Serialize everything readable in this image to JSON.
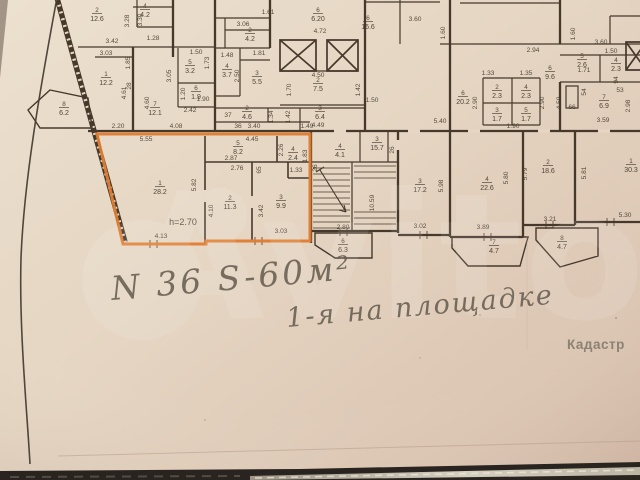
{
  "photo": {
    "watermark_text": "Avito",
    "kadastr_text": "Кадастр",
    "paper_light": "#ece0cf",
    "paper_mid": "#e5d5c2",
    "paper_dark": "#d5bcaa",
    "ink_color": "#46392c",
    "highlight_color": "#e07c30",
    "pencil_color": "#675e51",
    "table_color": "#29241f"
  },
  "annotations": {
    "apartment_note": "N 36  S-60м²",
    "floor_note": "1-я на площадке",
    "height_note": "h=2.70"
  },
  "plan": {
    "rooms": [
      {
        "n": "2",
        "a": "12.6",
        "x": 97,
        "y": 12
      },
      {
        "n": "4",
        "a": "4.2",
        "x": 145,
        "y": 8
      },
      {
        "n": "1",
        "a": "12.2",
        "x": 106,
        "y": 76
      },
      {
        "n": "8",
        "a": "6.2",
        "x": 64,
        "y": 106
      },
      {
        "n": "7",
        "a": "12.1",
        "x": 155,
        "y": 106
      },
      {
        "n": "5",
        "a": "3.2",
        "x": 190,
        "y": 64
      },
      {
        "n": "6",
        "a": "1.9",
        "x": 196,
        "y": 90
      },
      {
        "n": "4",
        "a": "3.7",
        "x": 227,
        "y": 68
      },
      {
        "n": "3",
        "a": "5.5",
        "x": 257,
        "y": 75
      },
      {
        "n": "2",
        "a": "4.2",
        "x": 250,
        "y": 32
      },
      {
        "n": "2",
        "a": "4.6",
        "x": 247,
        "y": 110
      },
      {
        "n": "3",
        "a": "6.4",
        "x": 320,
        "y": 110
      },
      {
        "n": "2",
        "a": "7.5",
        "x": 318,
        "y": 82
      },
      {
        "n": "6",
        "a": "6.20",
        "x": 318,
        "y": 12
      },
      {
        "n": "6",
        "a": "16.6",
        "x": 368,
        "y": 20
      },
      {
        "n": "6",
        "a": "20.2",
        "x": 463,
        "y": 95
      },
      {
        "n": "2",
        "a": "2.3",
        "x": 497,
        "y": 89
      },
      {
        "n": "4",
        "a": "2.3",
        "x": 526,
        "y": 89
      },
      {
        "n": "3",
        "a": "1.7",
        "x": 497,
        "y": 112
      },
      {
        "n": "5",
        "a": "1.7",
        "x": 526,
        "y": 112
      },
      {
        "n": "6",
        "a": "9.6",
        "x": 550,
        "y": 70
      },
      {
        "n": "5",
        "a": "2.6",
        "x": 582,
        "y": 58
      },
      {
        "n": "4",
        "a": "2.3",
        "x": 616,
        "y": 62
      },
      {
        "n": "7",
        "a": "6.9",
        "x": 604,
        "y": 99
      },
      {
        "n": "3",
        "a": "15.7",
        "x": 377,
        "y": 141
      },
      {
        "n": "4",
        "a": "4.1",
        "x": 340,
        "y": 148
      },
      {
        "n": "6",
        "a": "6.3",
        "x": 343,
        "y": 243
      },
      {
        "n": "3",
        "a": "17.2",
        "x": 420,
        "y": 183
      },
      {
        "n": "4",
        "a": "22.6",
        "x": 487,
        "y": 181
      },
      {
        "n": "2",
        "a": "18.6",
        "x": 548,
        "y": 164
      },
      {
        "n": "1",
        "a": "30.3",
        "x": 631,
        "y": 163
      },
      {
        "n": "7",
        "a": "4.7",
        "x": 494,
        "y": 244
      },
      {
        "n": "8",
        "a": "4.7",
        "x": 562,
        "y": 240
      },
      {
        "n": "1",
        "a": "28.2",
        "x": 160,
        "y": 185
      },
      {
        "n": "2",
        "a": "11.3",
        "x": 230,
        "y": 200
      },
      {
        "n": "3",
        "a": "9.9",
        "x": 281,
        "y": 199
      },
      {
        "n": "5",
        "a": "8.2",
        "x": 238,
        "y": 145
      },
      {
        "n": "4",
        "a": "2.4",
        "x": 293,
        "y": 151
      }
    ],
    "dims": [
      {
        "t": "3.42",
        "x": 112,
        "y": 43
      },
      {
        "t": "3.03",
        "x": 106,
        "y": 55
      },
      {
        "t": "1.85",
        "x": 130,
        "y": 63,
        "v": 1
      },
      {
        "t": "3.28",
        "x": 129,
        "y": 21,
        "v": 1
      },
      {
        "t": "3.30",
        "x": 142,
        "y": 20,
        "v": 1
      },
      {
        "t": "1.28",
        "x": 153,
        "y": 40
      },
      {
        "t": "4.61",
        "x": 126,
        "y": 93,
        "v": 1
      },
      {
        "t": "4.60",
        "x": 149,
        "y": 103,
        "v": 1
      },
      {
        "t": "28",
        "x": 131,
        "y": 86,
        "v": 1
      },
      {
        "t": "2.20",
        "x": 118,
        "y": 128
      },
      {
        "t": "4.08",
        "x": 176,
        "y": 128
      },
      {
        "t": "1.61",
        "x": 268,
        "y": 14
      },
      {
        "t": "3.06",
        "x": 243,
        "y": 26
      },
      {
        "t": "1.50",
        "x": 196,
        "y": 54
      },
      {
        "t": "1.73",
        "x": 209,
        "y": 63,
        "v": 1
      },
      {
        "t": "1.48",
        "x": 227,
        "y": 57
      },
      {
        "t": "1.81",
        "x": 259,
        "y": 55
      },
      {
        "t": "2.50",
        "x": 239,
        "y": 76,
        "v": 1
      },
      {
        "t": "3.05",
        "x": 171,
        "y": 76,
        "v": 1
      },
      {
        "t": "1.20",
        "x": 185,
        "y": 94,
        "v": 1
      },
      {
        "t": "1.90",
        "x": 203,
        "y": 101
      },
      {
        "t": "2.42",
        "x": 190,
        "y": 112
      },
      {
        "t": "1.34",
        "x": 273,
        "y": 117,
        "v": 1
      },
      {
        "t": "1.42",
        "x": 290,
        "y": 117,
        "v": 1
      },
      {
        "t": "37",
        "x": 228,
        "y": 117
      },
      {
        "t": "36",
        "x": 238,
        "y": 128
      },
      {
        "t": "3.40",
        "x": 254,
        "y": 128
      },
      {
        "t": "4.72",
        "x": 320,
        "y": 33
      },
      {
        "t": "4.50",
        "x": 318,
        "y": 77
      },
      {
        "t": "1.70",
        "x": 291,
        "y": 90,
        "v": 1
      },
      {
        "t": "1.42",
        "x": 360,
        "y": 90,
        "v": 1
      },
      {
        "t": "1.50",
        "x": 372,
        "y": 102
      },
      {
        "t": "4.49",
        "x": 318,
        "y": 127
      },
      {
        "t": "1.49",
        "x": 307,
        "y": 128
      },
      {
        "t": "3.60",
        "x": 415,
        "y": 21
      },
      {
        "t": "1.60",
        "x": 445,
        "y": 33,
        "v": 1
      },
      {
        "t": "1.60",
        "x": 575,
        "y": 34,
        "v": 1
      },
      {
        "t": "2.94",
        "x": 533,
        "y": 52
      },
      {
        "t": "3.60",
        "x": 601,
        "y": 44
      },
      {
        "t": "1.50",
        "x": 611,
        "y": 53
      },
      {
        "t": "1.33",
        "x": 488,
        "y": 75
      },
      {
        "t": "1.35",
        "x": 526,
        "y": 75
      },
      {
        "t": "2.90",
        "x": 477,
        "y": 103,
        "v": 1
      },
      {
        "t": "2.90",
        "x": 544,
        "y": 103,
        "v": 1
      },
      {
        "t": "4.59",
        "x": 561,
        "y": 103,
        "v": 1
      },
      {
        "t": "66",
        "x": 572,
        "y": 109
      },
      {
        "t": "54",
        "x": 586,
        "y": 92,
        "v": 1
      },
      {
        "t": "94",
        "x": 618,
        "y": 80,
        "v": 1
      },
      {
        "t": "53",
        "x": 620,
        "y": 92
      },
      {
        "t": "2.98",
        "x": 630,
        "y": 106,
        "v": 1
      },
      {
        "t": "1.71",
        "x": 584,
        "y": 72
      },
      {
        "t": "1.90",
        "x": 513,
        "y": 128
      },
      {
        "t": "3.59",
        "x": 603,
        "y": 122
      },
      {
        "t": "5.40",
        "x": 440,
        "y": 123
      },
      {
        "t": "5.55",
        "x": 146,
        "y": 141
      },
      {
        "t": "4.45",
        "x": 252,
        "y": 141
      },
      {
        "t": "2.87",
        "x": 231,
        "y": 160
      },
      {
        "t": "2.76",
        "x": 237,
        "y": 170
      },
      {
        "t": "5.82",
        "x": 196,
        "y": 185,
        "v": 1
      },
      {
        "t": "4.10",
        "x": 213,
        "y": 211,
        "v": 1
      },
      {
        "t": "3.42",
        "x": 263,
        "y": 211,
        "v": 1
      },
      {
        "t": "2.26",
        "x": 283,
        "y": 150,
        "v": 1
      },
      {
        "t": "65",
        "x": 261,
        "y": 170,
        "v": 1
      },
      {
        "t": "1.33",
        "x": 296,
        "y": 172
      },
      {
        "t": "1.83",
        "x": 307,
        "y": 156,
        "v": 1
      },
      {
        "t": "26",
        "x": 317,
        "y": 168,
        "v": 1
      },
      {
        "t": "4.13",
        "x": 161,
        "y": 238
      },
      {
        "t": "3.03",
        "x": 281,
        "y": 233
      },
      {
        "t": "2.80",
        "x": 343,
        "y": 229
      },
      {
        "t": "10.59",
        "x": 374,
        "y": 203,
        "v": 1
      },
      {
        "t": "26",
        "x": 394,
        "y": 150,
        "v": 1
      },
      {
        "t": "3.02",
        "x": 420,
        "y": 228
      },
      {
        "t": "3.89",
        "x": 483,
        "y": 229
      },
      {
        "t": "3.21",
        "x": 550,
        "y": 221
      },
      {
        "t": "5.30",
        "x": 625,
        "y": 217
      },
      {
        "t": "5.98",
        "x": 443,
        "y": 186,
        "v": 1
      },
      {
        "t": "5.80",
        "x": 508,
        "y": 178,
        "v": 1
      },
      {
        "t": "5.79",
        "x": 527,
        "y": 174,
        "v": 1
      },
      {
        "t": "5.81",
        "x": 586,
        "y": 173,
        "v": 1
      }
    ]
  }
}
